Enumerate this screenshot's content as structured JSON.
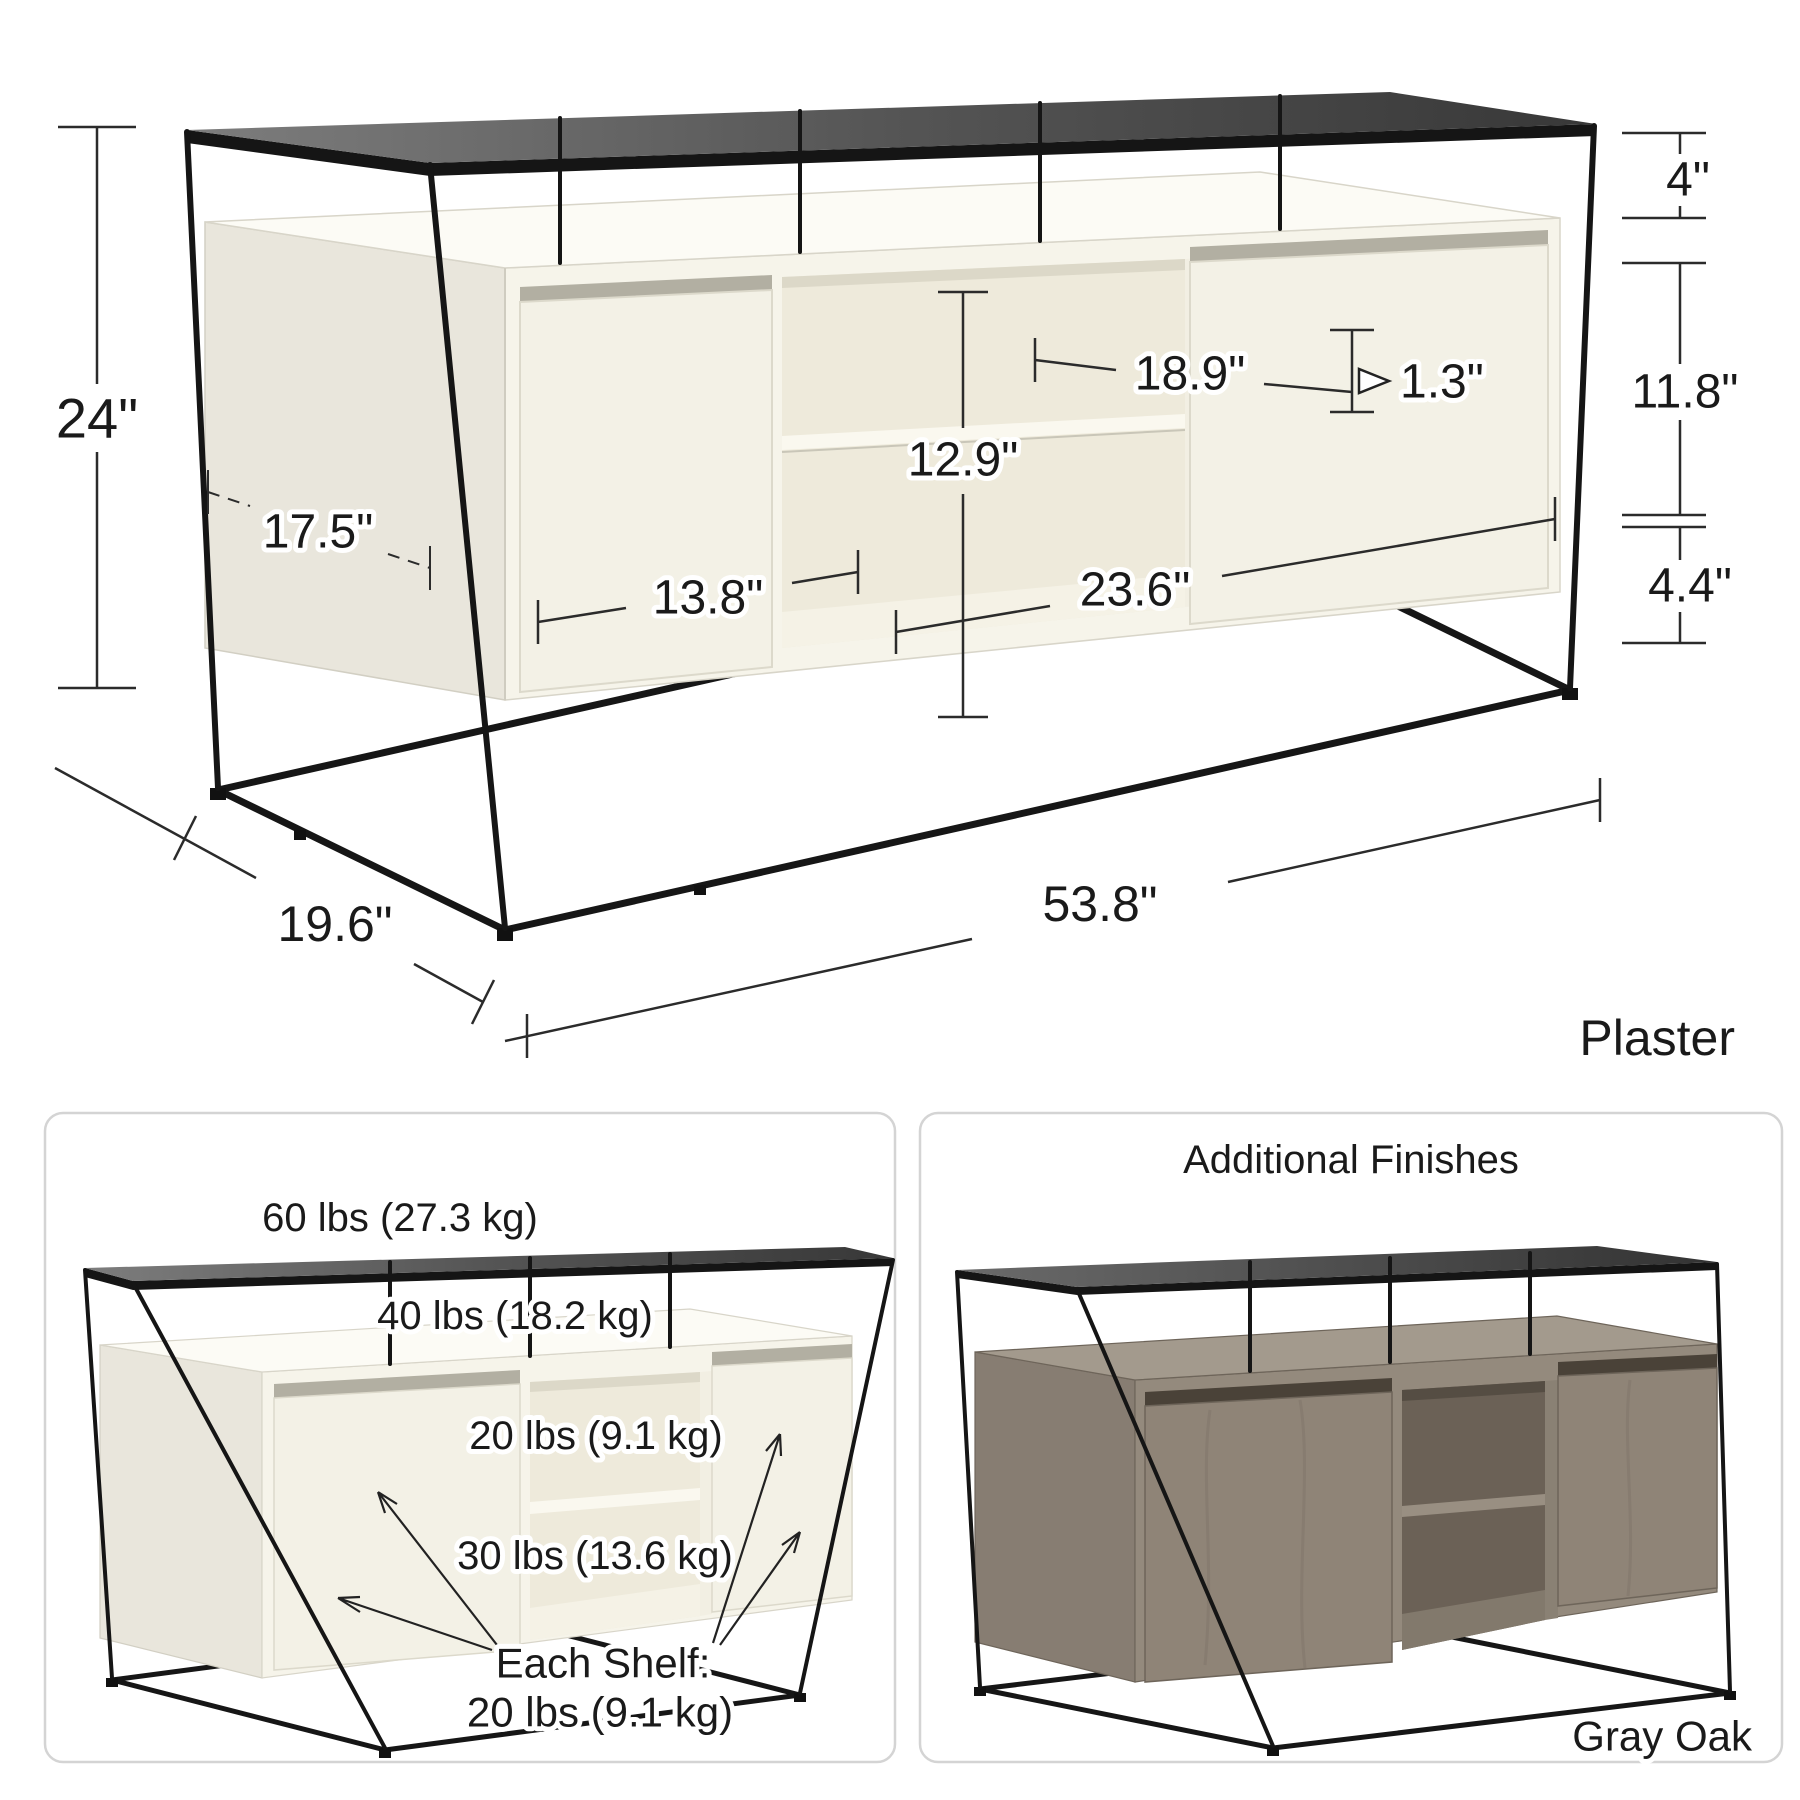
{
  "main_diagram": {
    "finish_label": "Plaster",
    "dimensions": {
      "overall_height": "24\"",
      "top_shelf_gap": "4\"",
      "cabinet_interior_height": "11.8\"",
      "base_clearance": "4.4\"",
      "upper_opening_width": "18.9\"",
      "center_opening_height": "12.9\"",
      "shelf_thickness": "1.3\"",
      "lower_opening_width": "23.6\"",
      "side_depth": "17.5\"",
      "door_width": "13.8\"",
      "overall_width": "53.8\"",
      "overall_depth": "19.6\""
    }
  },
  "weight_capacity_panel": {
    "top_surface": "60 lbs (27.3 kg)",
    "media_shelf": "40 lbs (18.2 kg)",
    "upper_center_shelf": "20 lbs (9.1 kg)",
    "lower_center_shelf": "30 lbs (13.6 kg)",
    "door_shelf_label_line1": "Each Shelf:",
    "door_shelf_label_line2": "20 lbs (9.1 kg)"
  },
  "finishes_panel": {
    "title": "Additional Finishes",
    "finish_label": "Gray Oak"
  },
  "colors": {
    "frame": "#1a1a1a",
    "plaster_body": "#f6f4ea",
    "gray_oak_body": "#948a7d",
    "panel_border": "#d4d4d4",
    "text": "#1a1a1a"
  }
}
